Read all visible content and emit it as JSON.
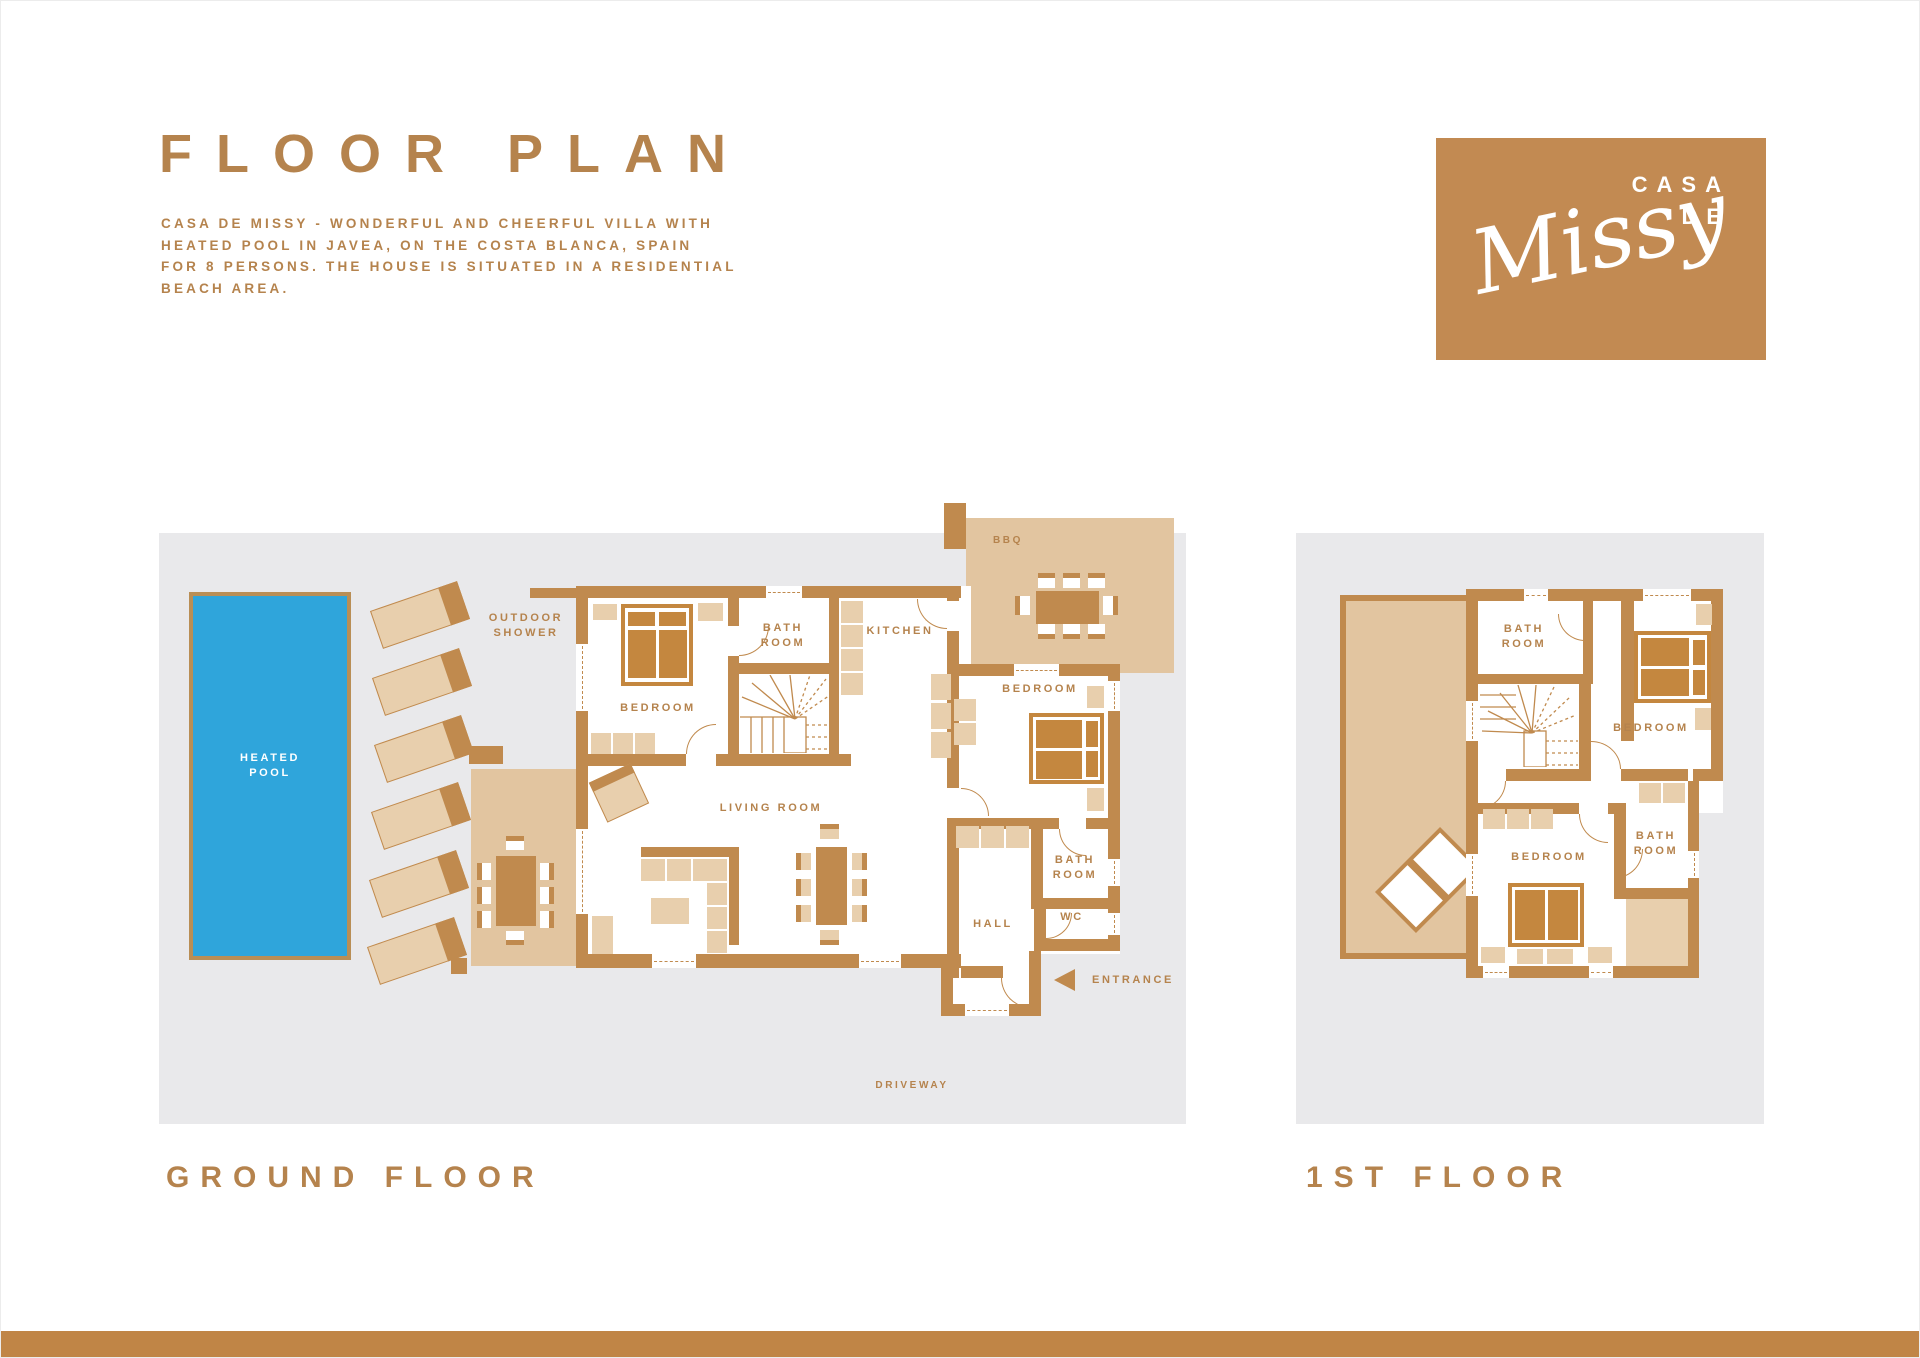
{
  "header": {
    "title": "FLOOR PLAN",
    "description": "CASA DE MISSY - WONDERFUL AND CHEERFUL VILLA WITH\nHEATED POOL IN JAVEA, ON THE COSTA BLANCA, SPAIN\nFOR 8 PERSONS. THE HOUSE IS SITUATED IN A RESIDENTIAL\nBEACH AREA."
  },
  "logo": {
    "line1": "CASA",
    "line2": "DE",
    "script": "Missy"
  },
  "ground": {
    "caption": "GROUND FLOOR",
    "labels": {
      "pool": "HEATED\nPOOL",
      "outdoor_shower": "OUTDOOR\nSHOWER",
      "bbq": "BBQ",
      "bedroom_left": "BEDROOM",
      "bathroom_top": "BATH\nROOM",
      "kitchen": "KITCHEN",
      "bedroom_right": "BEDROOM",
      "living_room": "LIVING ROOM",
      "bathroom_right": "BATH\nROOM",
      "wc": "WC",
      "hall": "HALL",
      "entrance": "ENTRANCE",
      "driveway": "DRIVEWAY"
    }
  },
  "first": {
    "caption": "1ST FLOOR",
    "labels": {
      "bathroom_top": "BATH\nROOM",
      "bedroom_top": "BEDROOM",
      "bedroom_bottom": "BEDROOM",
      "bathroom_bottom": "BATH\nROOM"
    }
  },
  "colors": {
    "wall": "#c08a4e",
    "bed": "#c4873f",
    "tan": "#e8cfad",
    "terrace": "#e2c5a0",
    "panel": "#e9e9eb",
    "pool": "#2fa5db",
    "text": "#b5834d",
    "logo_bg": "#c28a52",
    "footer": "#c08546",
    "pool_border": "#b98e55"
  }
}
